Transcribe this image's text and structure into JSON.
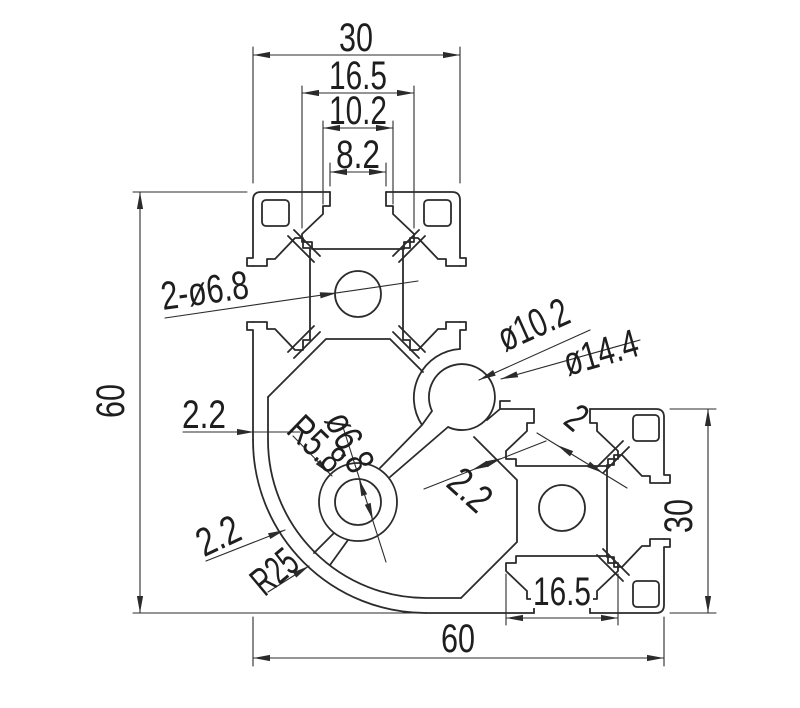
{
  "drawing": {
    "type": "technical-drawing",
    "subject": "Aluminum extrusion corner profile cross-section with dimensions",
    "colors": {
      "line": "#2b2b2b",
      "background": "#ffffff"
    },
    "dims": {
      "top_overall": "30",
      "top_slot_width": "16.5",
      "top_slot_throat": "10.2",
      "top_slot_opening": "8.2",
      "overall_height": "60",
      "core_holes": "2-ø6.8",
      "corner_channel_bore": "ø10.2",
      "corner_channel_outer": "ø14.4",
      "wall_left": "2.2",
      "boss_radius": "R5.8",
      "boss_bore": "ø6.8",
      "wall_channel": "2.2",
      "wall_web": "2",
      "right_overall": "30",
      "wall_arc": "2.2",
      "corner_radius": "R25",
      "bottom_slot_width": "16.5",
      "bottom_overall": "60"
    }
  }
}
